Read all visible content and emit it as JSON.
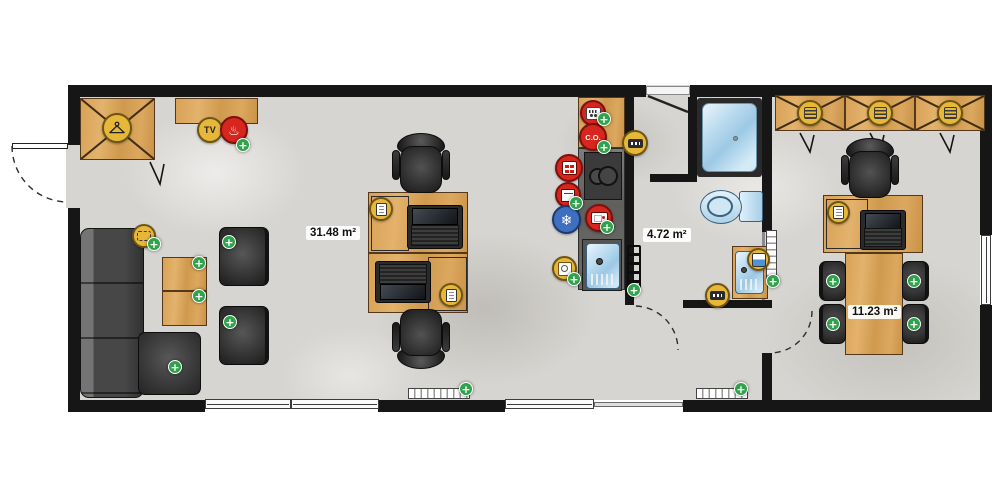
{
  "title": "Floor plan",
  "rooms": [
    {
      "name": "main room",
      "area_label": "31.48 m²",
      "objects": [
        "wardrobe",
        "TV sideboard",
        "electric heater",
        "corner sofa",
        "coffee table",
        "armchair",
        "armchair",
        "rug marker",
        "desk",
        "desk",
        "laptop",
        "laptop",
        "office chair",
        "office chair",
        "kitchen counter",
        "cooktop",
        "oven",
        "fridge-freezer",
        "microwave",
        "kitchen sink",
        "dishwasher",
        "smoke detector",
        "CO detector",
        "radiator"
      ]
    },
    {
      "name": "hallway",
      "area_label": "4.72 m²",
      "objects": [
        "entrance door",
        "towel radiator",
        "electrical panel",
        "thermostat panel",
        "radiator"
      ]
    },
    {
      "name": "bathroom",
      "area_label": "",
      "objects": [
        "shower",
        "toilet",
        "washbasin vanity",
        "water heater"
      ]
    },
    {
      "name": "small room",
      "area_label": "11.23 m²",
      "objects": [
        "wardrobe",
        "wardrobe",
        "wardrobe",
        "desk",
        "laptop",
        "office chair",
        "meeting table",
        "chair",
        "chair",
        "chair",
        "chair",
        "radiator"
      ]
    }
  ],
  "icon_labels": {
    "tv": "TV",
    "co_detector": "C.O."
  },
  "glyphs": {
    "plus": "+",
    "snowflake": "❄",
    "heat": "♨"
  },
  "colors": {
    "wall": "#161616",
    "floor": "#d7d5d1",
    "wood": "#d8a257",
    "furniture_dark": "#3c3c3c",
    "marker_yellow": "#e7b73a",
    "marker_red": "#d6261d",
    "marker_blue": "#3f6fc0",
    "badge_green": "#2fa24b",
    "fixture_blue": "#bfe0f2"
  }
}
